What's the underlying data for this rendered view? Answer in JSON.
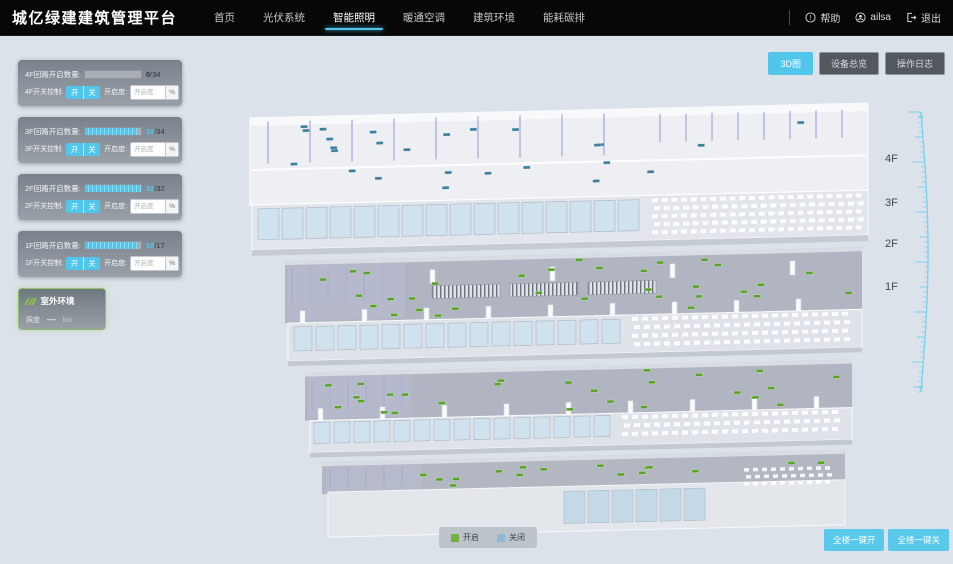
{
  "app": {
    "title": "城亿绿建建筑管理平台"
  },
  "nav": {
    "items": [
      {
        "label": "首页",
        "active": false
      },
      {
        "label": "光伏系统",
        "active": false
      },
      {
        "label": "智能照明",
        "active": true
      },
      {
        "label": "暖通空调",
        "active": false
      },
      {
        "label": "建筑环境",
        "active": false
      },
      {
        "label": "能耗碳排",
        "active": false
      }
    ],
    "help_label": "帮助",
    "username": "ailsa",
    "logout_label": "退出"
  },
  "view_buttons": [
    {
      "label": "3D图",
      "active": true
    },
    {
      "label": "设备总览",
      "active": false
    },
    {
      "label": "操作日志",
      "active": false
    }
  ],
  "floor_panels": [
    {
      "floor": "4F",
      "circuit_label": "4F回路开启数量:",
      "on": 0,
      "total": 34,
      "switch_label": "4F开关控制:",
      "on_btn": "开",
      "off_btn": "关",
      "dim_label": "开启度:",
      "dim_placeholder": "开启度",
      "unit": "%"
    },
    {
      "floor": "3F",
      "circuit_label": "3F回路开启数量:",
      "on": 32,
      "total": 34,
      "switch_label": "3F开关控制:",
      "on_btn": "开",
      "off_btn": "关",
      "dim_label": "开启度:",
      "dim_placeholder": "开启度",
      "unit": "%"
    },
    {
      "floor": "2F",
      "circuit_label": "2F回路开启数量:",
      "on": 32,
      "total": 32,
      "switch_label": "2F开关控制:",
      "on_btn": "开",
      "off_btn": "关",
      "dim_label": "开启度:",
      "dim_placeholder": "开启度",
      "unit": "%"
    },
    {
      "floor": "1F",
      "circuit_label": "1F回路开启数量:",
      "on": 16,
      "total": 17,
      "switch_label": "1F开关控制:",
      "on_btn": "开",
      "off_btn": "关",
      "dim_label": "开启度:",
      "dim_placeholder": "开启度",
      "unit": "%"
    }
  ],
  "outdoor": {
    "title": "室外环境",
    "metric": {
      "label": "照度",
      "value": "—",
      "unit": "lux"
    }
  },
  "floor_markers": [
    "4F",
    "3F",
    "2F",
    "1F"
  ],
  "legend": [
    {
      "label": "开启",
      "color": "#76b043"
    },
    {
      "label": "关闭",
      "color": "#8fb7d7"
    }
  ],
  "bulk_actions": [
    "全楼一键开",
    "全楼一键关"
  ],
  "colors": {
    "accent": "#52c5ea",
    "off_count": "#31363c"
  },
  "scene": {
    "floors": [
      {
        "id": "4F",
        "dot_color": "#3f7f9e",
        "dot_count": 26
      },
      {
        "id": "3F",
        "dot_color": "#5aa328",
        "dot_count": 32
      },
      {
        "id": "2F",
        "dot_color": "#5aa328",
        "dot_count": 26
      },
      {
        "id": "1F",
        "dot_color": "#5aa328",
        "dot_count": 16
      }
    ]
  }
}
